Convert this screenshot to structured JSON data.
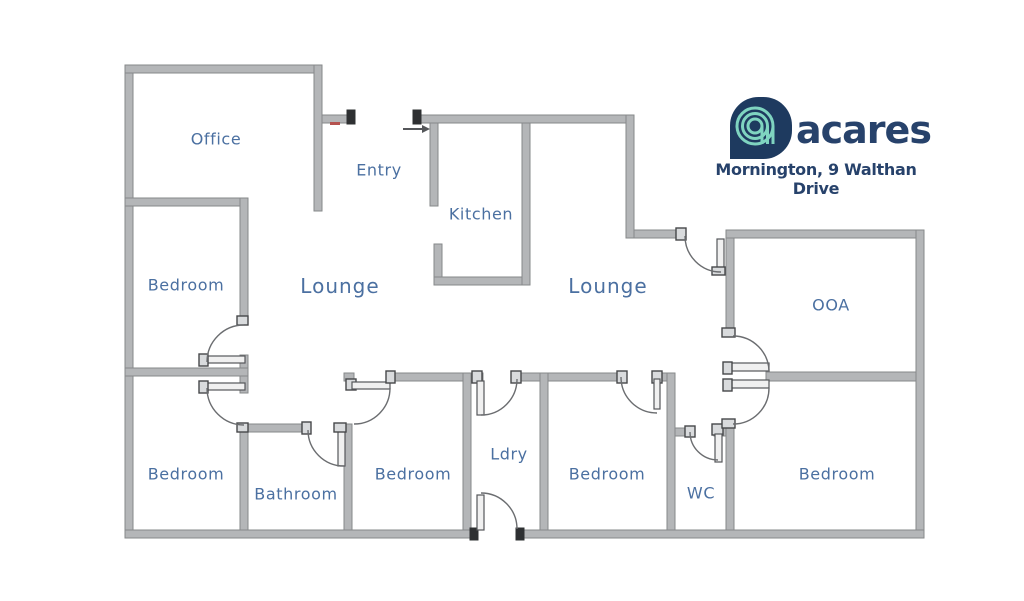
{
  "brand": {
    "name": "acares",
    "address": "Mornington, 9 Walthan Drive",
    "colors": {
      "navy": "#1e3a5f",
      "text_navy": "#27426b",
      "mint": "#7fd4c0"
    }
  },
  "floorplan": {
    "wall_color": "#b4b6b8",
    "label_color": "#4b70a1",
    "rooms": [
      {
        "id": "office",
        "label": "Office",
        "x": 216,
        "y": 139,
        "size": "md"
      },
      {
        "id": "entry",
        "label": "Entry",
        "x": 379,
        "y": 170,
        "size": "md"
      },
      {
        "id": "kitchen",
        "label": "Kitchen",
        "x": 481,
        "y": 214,
        "size": "md"
      },
      {
        "id": "lounge-1",
        "label": "Lounge",
        "x": 340,
        "y": 286,
        "size": "lg"
      },
      {
        "id": "lounge-2",
        "label": "Lounge",
        "x": 608,
        "y": 286,
        "size": "lg"
      },
      {
        "id": "bedroom-1",
        "label": "Bedroom",
        "x": 186,
        "y": 285,
        "size": "md"
      },
      {
        "id": "ooa",
        "label": "OOA",
        "x": 831,
        "y": 305,
        "size": "md"
      },
      {
        "id": "bedroom-2",
        "label": "Bedroom",
        "x": 186,
        "y": 474,
        "size": "md"
      },
      {
        "id": "bathroom",
        "label": "Bathroom",
        "x": 296,
        "y": 494,
        "size": "md"
      },
      {
        "id": "bedroom-3",
        "label": "Bedroom",
        "x": 413,
        "y": 474,
        "size": "md"
      },
      {
        "id": "laundry",
        "label": "Ldry",
        "x": 509,
        "y": 454,
        "size": "md"
      },
      {
        "id": "bedroom-4",
        "label": "Bedroom",
        "x": 607,
        "y": 474,
        "size": "md"
      },
      {
        "id": "wc",
        "label": "WC",
        "x": 701,
        "y": 493,
        "size": "md"
      },
      {
        "id": "bedroom-5",
        "label": "Bedroom",
        "x": 837,
        "y": 474,
        "size": "md"
      }
    ]
  }
}
